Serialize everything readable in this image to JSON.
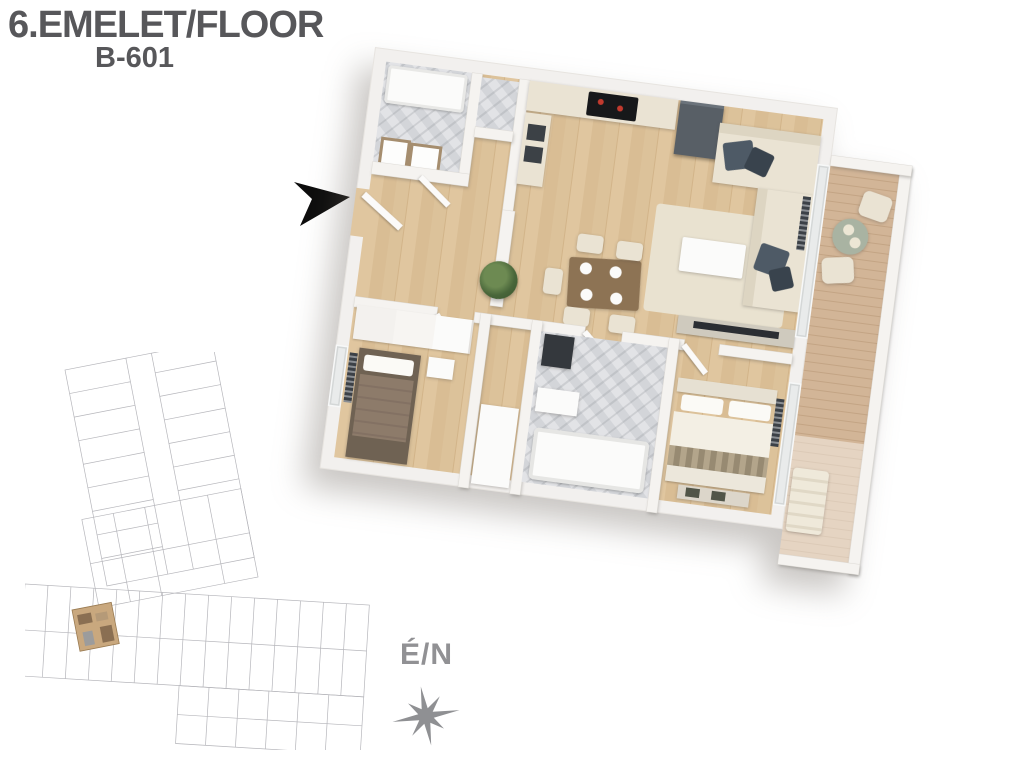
{
  "header": {
    "floor_label": "6.EMELET/FLOOR",
    "unit_label": "B-601"
  },
  "compass": {
    "label": "É/N"
  },
  "icons": {
    "entrance_arrow": "black-right-arrow",
    "compass_rose": "eight-point-star"
  },
  "colors": {
    "title_text": "#57575a",
    "compass_gray": "#919194",
    "arrow_black": "#0c0c0c",
    "wall_white": "#f2f0ee",
    "wood_floor": "#dcc29a",
    "bath_tile": "#d8dade",
    "sofa_cream": "#eae3d3",
    "pillow_slate": "#4e5a66",
    "fridge_gray": "#585f66",
    "dining_table_wood": "#8d7354",
    "bed_throw_brown": "#8d7b6a",
    "balcony_deck": "#cbb094",
    "patio_table_sage": "#a9b3a2",
    "siteplan_line": "#b6b6bb",
    "siteplan_unit_highlight": "#c9a87e"
  }
}
